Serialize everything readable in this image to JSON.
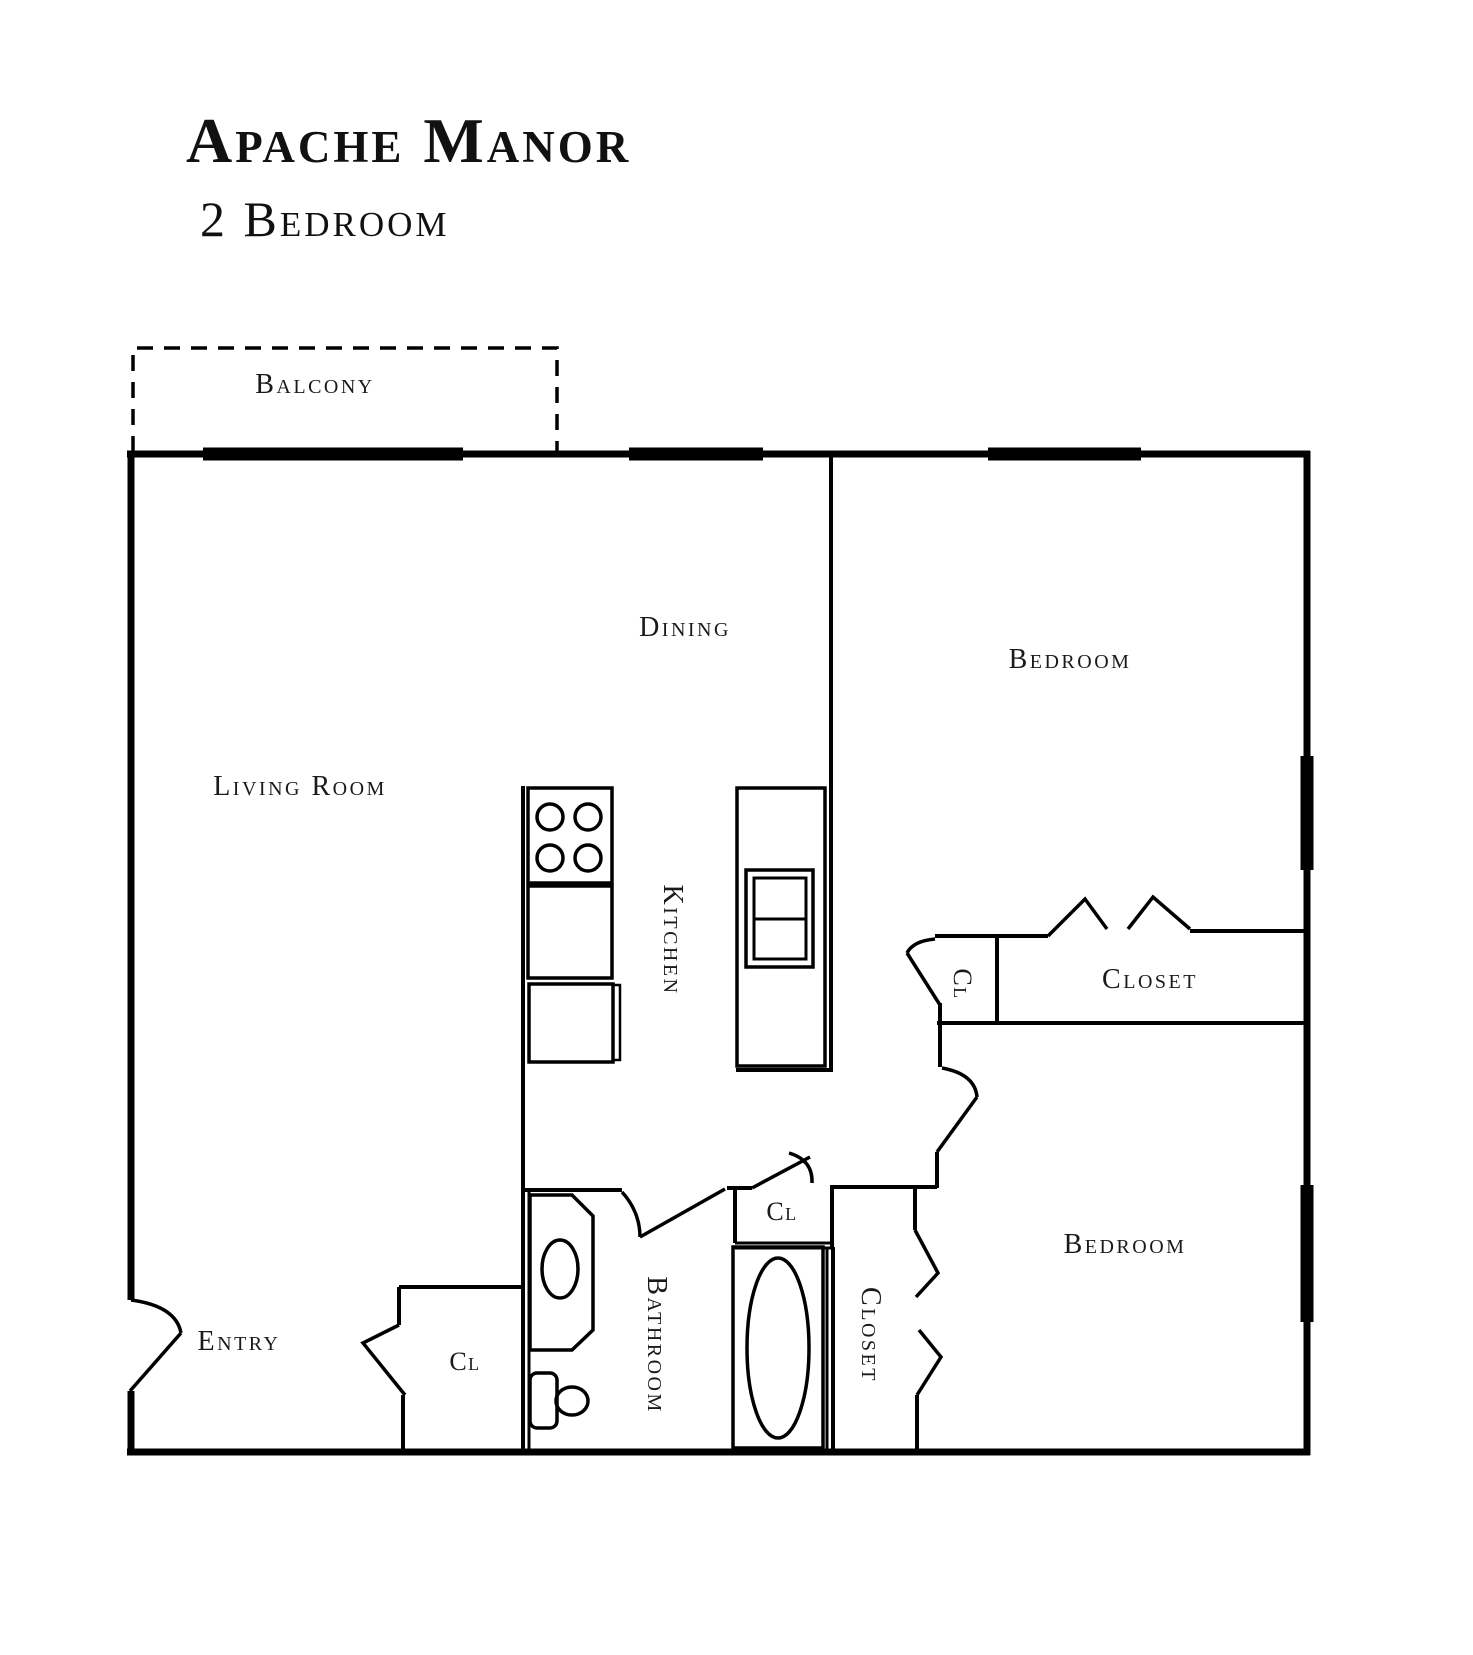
{
  "title": {
    "line1": "Apache Manor",
    "line2": "2 Bedroom"
  },
  "rooms": {
    "balcony": "Balcony",
    "living_room": "Living Room",
    "dining": "Dining",
    "kitchen": "Kitchen",
    "bedroom_top": "Bedroom",
    "bedroom_bottom": "Bedroom",
    "closet_top": "Closet",
    "closet_bottom": "Closet",
    "bathroom": "Bathroom",
    "entry": "Entry",
    "cl_top": "Cl",
    "cl_bath": "Cl",
    "cl_entry": "Cl"
  },
  "colors": {
    "wall": "#000000",
    "text": "#1a1a1a",
    "background": "#ffffff"
  }
}
